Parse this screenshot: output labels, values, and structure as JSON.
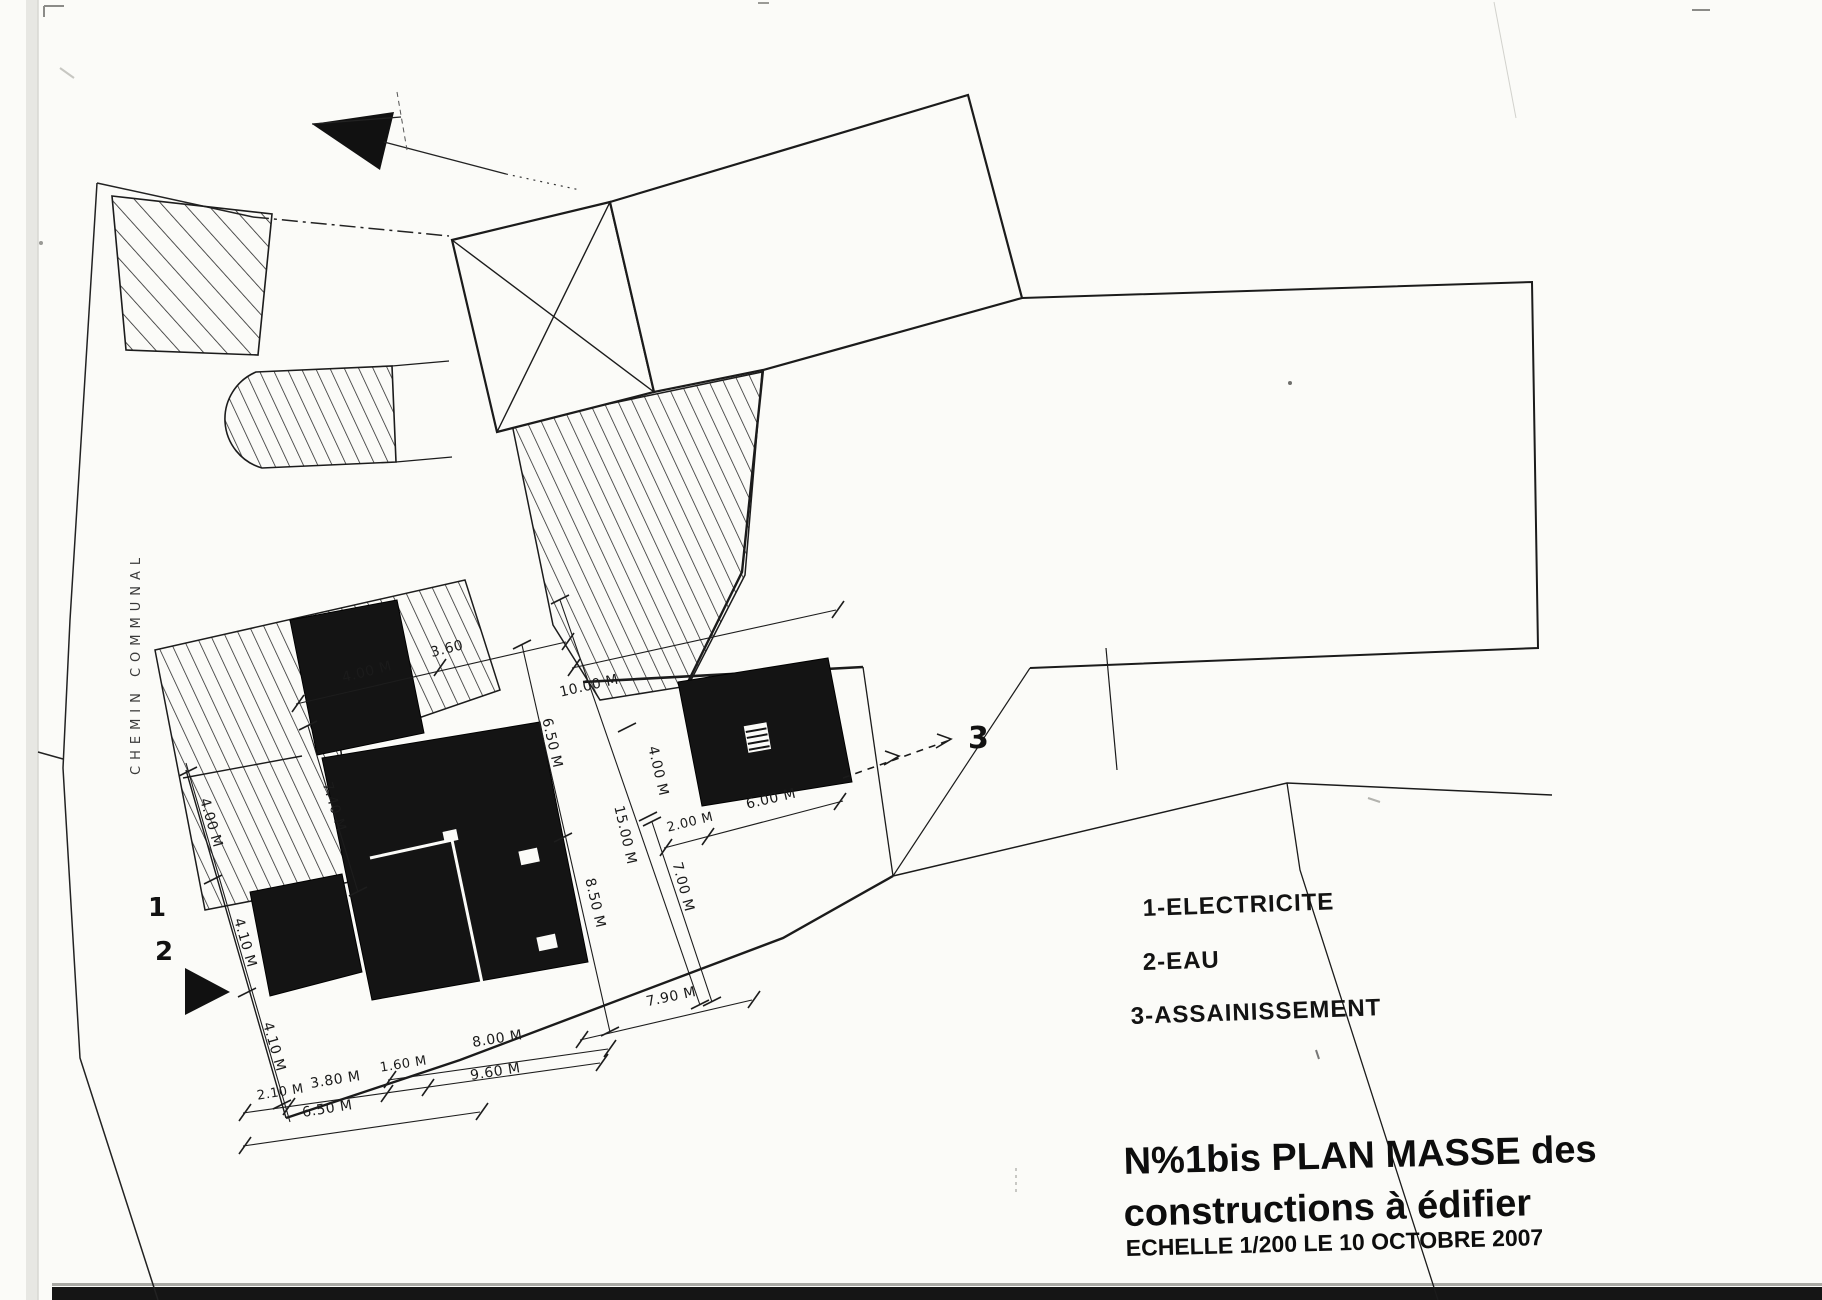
{
  "document": {
    "road_label": "CHEMIN    COMMUNAL",
    "markers": {
      "one": "1",
      "two": "2",
      "three": "3"
    },
    "legend": [
      "1-ELECTRICITE",
      "2-EAU",
      "3-ASSAINISSEMENT"
    ],
    "title": {
      "line1": "N%1bis PLAN  MASSE  des",
      "line2": "constructions à édifier",
      "line3": "ECHELLE 1/200  LE  10   OCTOBRE 2007"
    },
    "colors": {
      "ink": "#1b1b1b",
      "building_fill": "#141414",
      "paper": "#fbfbf8"
    }
  },
  "dimensions": [
    {
      "text": "4.00 M",
      "x": 368,
      "y": 676,
      "r": -14
    },
    {
      "text": "3.60",
      "x": 448,
      "y": 653,
      "r": -14
    },
    {
      "text": "10.00 M",
      "x": 590,
      "y": 690,
      "r": -13
    },
    {
      "text": "6.50 M",
      "x": 548,
      "y": 744,
      "r": 77
    },
    {
      "text": "7.40 M",
      "x": 330,
      "y": 808,
      "r": 73
    },
    {
      "text": "4.00 M",
      "x": 654,
      "y": 772,
      "r": 77
    },
    {
      "text": "15.00 M",
      "x": 621,
      "y": 836,
      "r": 77
    },
    {
      "text": "2.00 M",
      "x": 691,
      "y": 826,
      "r": -14,
      "s": 13
    },
    {
      "text": "6.00 M",
      "x": 772,
      "y": 803,
      "r": -13
    },
    {
      "text": "7.00 M",
      "x": 679,
      "y": 888,
      "r": 75
    },
    {
      "text": "8.50 M",
      "x": 591,
      "y": 904,
      "r": 77
    },
    {
      "text": "7.90 M",
      "x": 672,
      "y": 1001,
      "r": -12
    },
    {
      "text": "4.00 M",
      "x": 207,
      "y": 824,
      "r": 74
    },
    {
      "text": "4.10 M",
      "x": 241,
      "y": 944,
      "r": 74
    },
    {
      "text": "4.10 M",
      "x": 270,
      "y": 1048,
      "r": 74
    },
    {
      "text": "8.00 M",
      "x": 498,
      "y": 1043,
      "r": -9
    },
    {
      "text": "2.10 M",
      "x": 281,
      "y": 1096,
      "r": -9,
      "s": 13
    },
    {
      "text": "3.80 M",
      "x": 336,
      "y": 1084,
      "r": -9
    },
    {
      "text": "1.60 M",
      "x": 404,
      "y": 1068,
      "r": -9,
      "s": 13
    },
    {
      "text": "9.60 M",
      "x": 496,
      "y": 1076,
      "r": -9
    },
    {
      "text": "6.50 M",
      "x": 328,
      "y": 1113,
      "r": -9
    }
  ]
}
